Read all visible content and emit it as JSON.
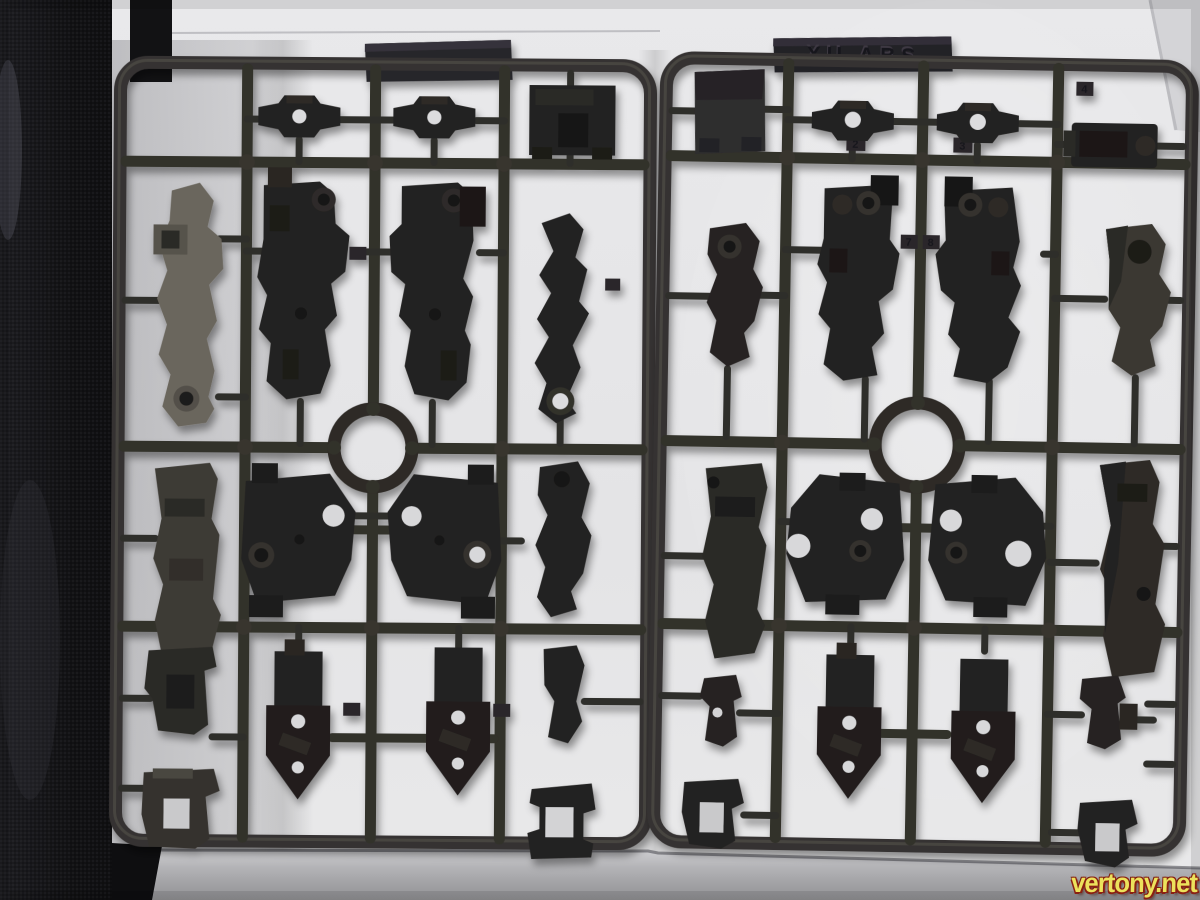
{
  "watermark": {
    "text": "vertony.net"
  },
  "sprues": {
    "right": {
      "nameplate_text": "XU  ABS"
    },
    "left": {
      "nameplate_text": ""
    },
    "part_tags": {
      "t2": "2",
      "t3": "3",
      "t4": "4",
      "t7": "7",
      "t8": "8"
    }
  },
  "colors": {
    "plastic_runner": "#343230",
    "plastic_part": "#242220",
    "plastic_part_dark": "#1e1c1a",
    "plastic_part_light": "#6a665d",
    "paper": "#e7e7e9",
    "paper_foreground": "#9b9b9e",
    "fabric_backdrop": "#141416",
    "watermark_fill": "#ece25c",
    "watermark_outline": "#8a2012"
  }
}
